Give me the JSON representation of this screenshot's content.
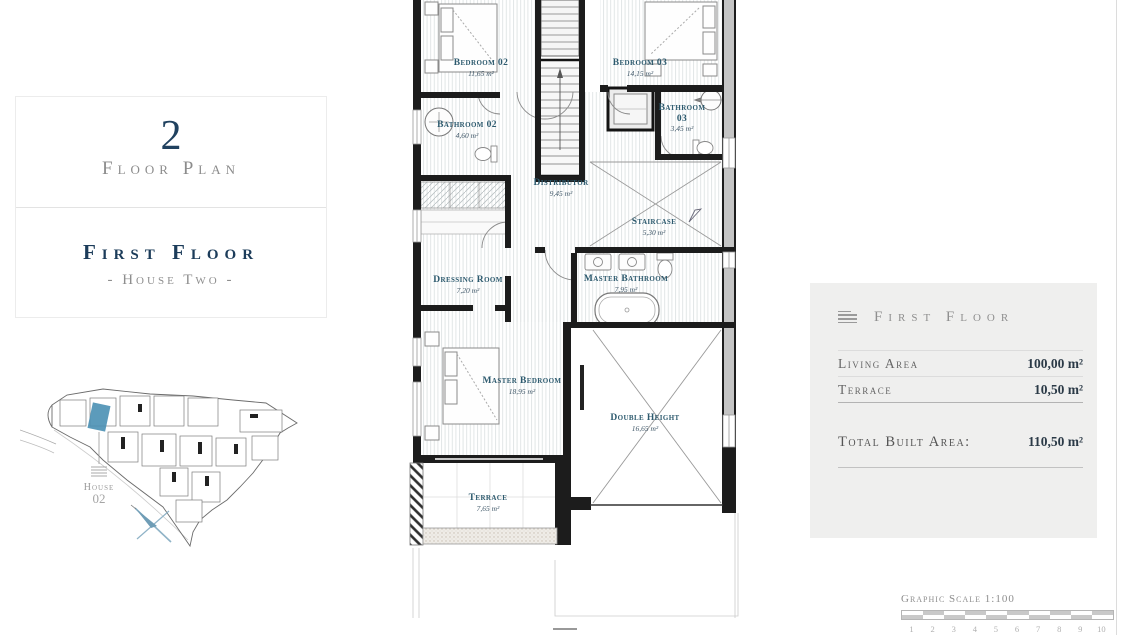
{
  "colors": {
    "accent_navy": "#1c3c5a",
    "room_label_teal": "#2d5a6e",
    "gray_text": "#8c8c8c",
    "panel_bg": "#efefee",
    "map_highlight_blue": "#4a90b4"
  },
  "left_panel": {
    "number": "2",
    "caption": "Floor Plan",
    "title": "First Floor",
    "subtitle": "- House Two -"
  },
  "site_map": {
    "house_label": "House",
    "house_number": "02"
  },
  "floor_plan": {
    "rooms": [
      {
        "name": "Bedroom 02",
        "area": "11,65 m²"
      },
      {
        "name": "Bedroom 03",
        "area": "14,15 m²"
      },
      {
        "name": "Bathroom 02",
        "area": "4,60 m²"
      },
      {
        "name": "Bathroom",
        "name2": "03",
        "area": "3,45 m²"
      },
      {
        "name": "Distributor",
        "area": "9,45 m²"
      },
      {
        "name": "Staircase",
        "area": "5,30 m²"
      },
      {
        "name": "Dressing Room",
        "area": "7,20 m²"
      },
      {
        "name": "Master Bathroom",
        "area": "7,95 m²"
      },
      {
        "name": "Master Bedroom",
        "area": "18,95 m²"
      },
      {
        "name": "Double Height",
        "area": "16,65 m²"
      },
      {
        "name": "Terrace",
        "area": "7,65 m²"
      }
    ]
  },
  "info_panel": {
    "title": "First Floor",
    "rows": [
      {
        "label": "Living Area",
        "value": "100,00 m²"
      },
      {
        "label": "Terrace",
        "value": "10,50 m²"
      }
    ],
    "total_label": "Total Built Area:",
    "total_value": "110,50 m²"
  },
  "scale_bar": {
    "label": "Graphic Scale 1:100",
    "ticks": [
      "1",
      "2",
      "3",
      "4",
      "5",
      "6",
      "7",
      "8",
      "9",
      "10"
    ]
  }
}
